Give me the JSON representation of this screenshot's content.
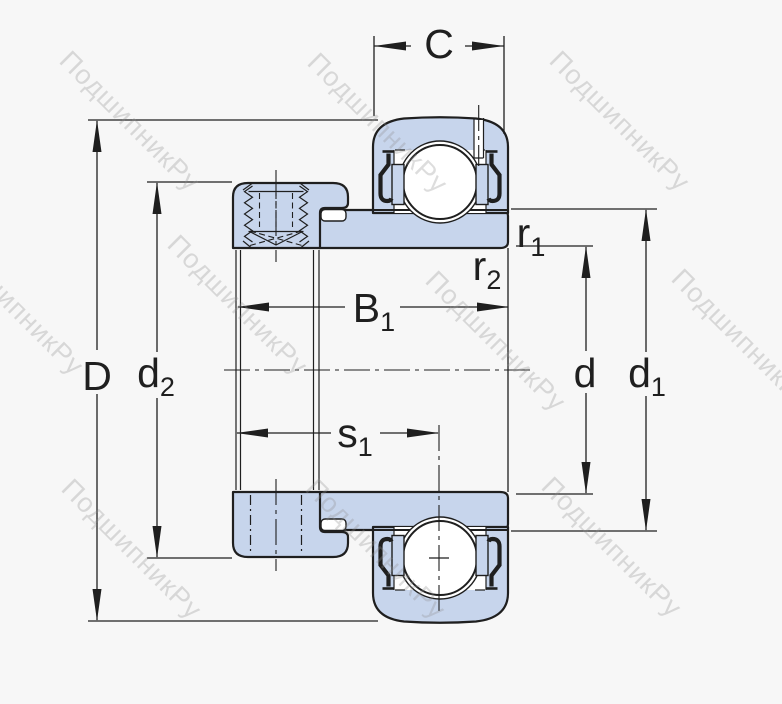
{
  "drawing": {
    "kind": "bearing cross-section technical drawing",
    "view": "insert ball bearing with eccentric locking collar, sectional view"
  },
  "watermark": {
    "text": "ПодшипникРу"
  },
  "labels": {
    "C": {
      "main": "C",
      "sub": ""
    },
    "D": {
      "main": "D",
      "sub": ""
    },
    "d2": {
      "main": "d",
      "sub": "2"
    },
    "B1": {
      "main": "B",
      "sub": "1"
    },
    "s1": {
      "main": "s",
      "sub": "1"
    },
    "r1": {
      "main": "r",
      "sub": "1"
    },
    "r2": {
      "main": "r",
      "sub": "2"
    },
    "d": {
      "main": "d",
      "sub": ""
    },
    "d1": {
      "main": "d",
      "sub": "1"
    }
  },
  "colors": {
    "background": "#f7f7f7",
    "white": "#ffffff",
    "line": "#1f1f1f",
    "part_fill": "#c7d5ec",
    "watermark": "#8f8f8f"
  }
}
